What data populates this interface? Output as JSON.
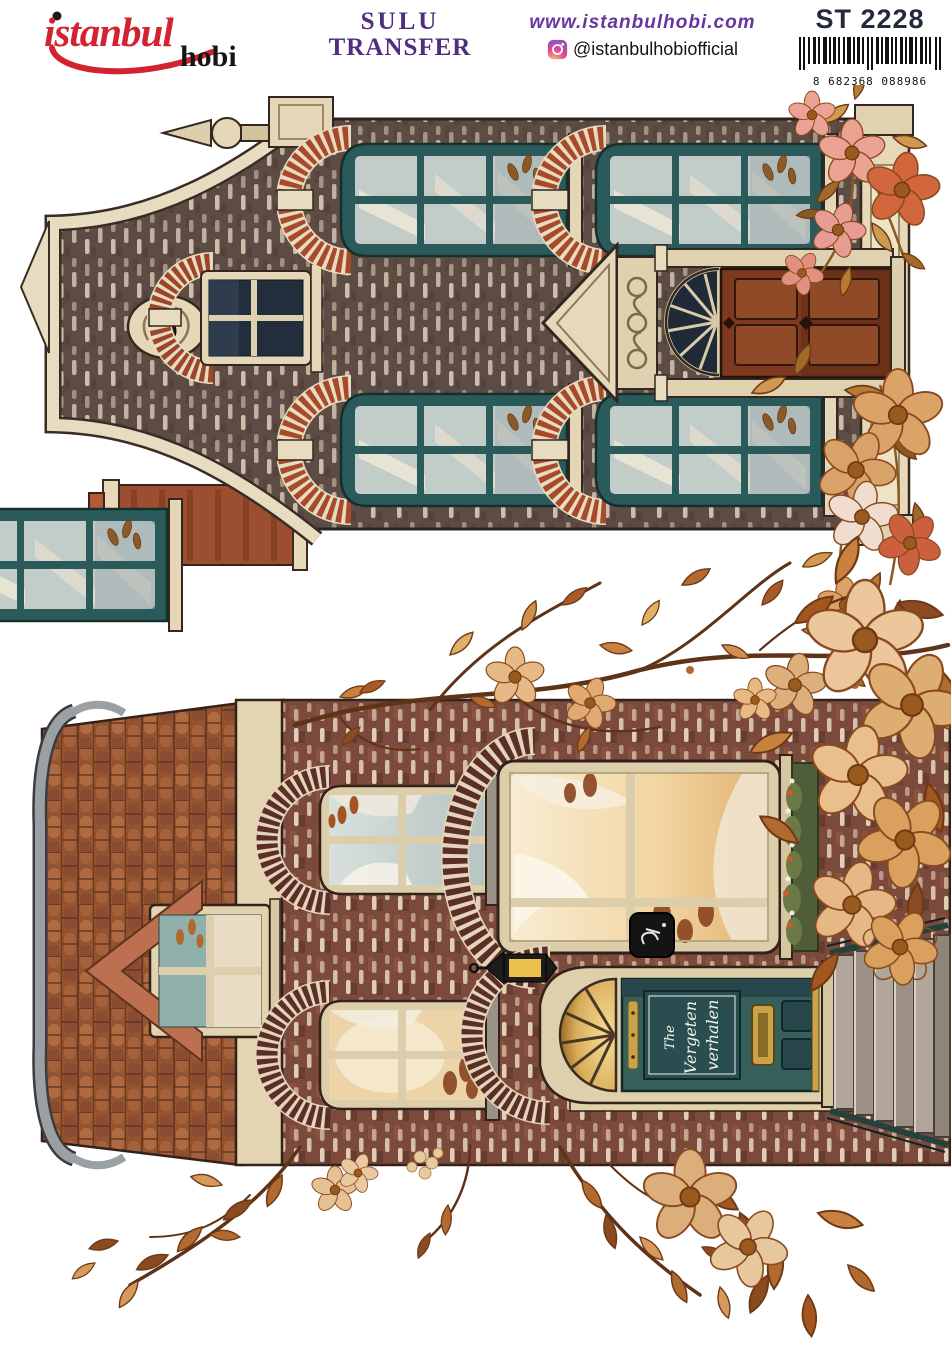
{
  "header": {
    "brand": {
      "word1": "istanbul",
      "word2": "hobi"
    },
    "product_type": {
      "line1": "SULU",
      "line2": "TRANSFER"
    },
    "website": "www.istanbulhobi.com",
    "instagram": {
      "handle": "@istanbulhobiofficial"
    },
    "product_code": "ST 2228",
    "barcode": {
      "prefix": "8",
      "group1": "682368",
      "group2": "088986",
      "display": "8 682368 088986"
    }
  },
  "artwork": {
    "medium": "watercolor autumn brick houses, craft water-transfer sheet",
    "orientation_note": "both house motifs are printed rotated 90 degrees counter-clockwise",
    "house_top": {
      "description": "Dutch canal house: neck gable with finial and carved ornament, taupe brick, six teal sash windows with red brick fan arches, pedimented brown panel door with navy fanlight, red brick chimney, pink and orange flowers at the corners"
    },
    "house_bottom": {
      "description": "Brick cottage: curved tiled roof with pointed dormer, two sash windows, glowing amber bay window with flower box, teal front door with lantern, number plaque and stone steps, surrounded by autumn branches and flowers",
      "door_sign": {
        "line1": "The",
        "line2": "Vergeten",
        "line3": "verhalen"
      }
    },
    "palette": {
      "brand_red": "#d42330",
      "brand_purple": "#4f2e7e",
      "code_navy": "#232b3d",
      "brick_taupe": "#5d4c44",
      "brick_red": "#7b4a3c",
      "mortar_cream": "#e8dcc0",
      "window_teal": "#2b5a5a",
      "door_teal": "#35605c",
      "door_brown": "#7d3a1e",
      "fan_brick_red": "#a8492b",
      "fan_brick_maroon": "#5a2f28",
      "roof_tile": "#93532f",
      "trim_cream": "#e3d4b2",
      "stone_grey": "#a99e92",
      "glow_amber": "#eec890",
      "leaf_rust": "#b26a2e",
      "leaf_gold": "#cf9a4f",
      "flower_tan": "#e2b284",
      "flower_pink": "#e89d94",
      "flower_orange": "#d2663d"
    }
  }
}
